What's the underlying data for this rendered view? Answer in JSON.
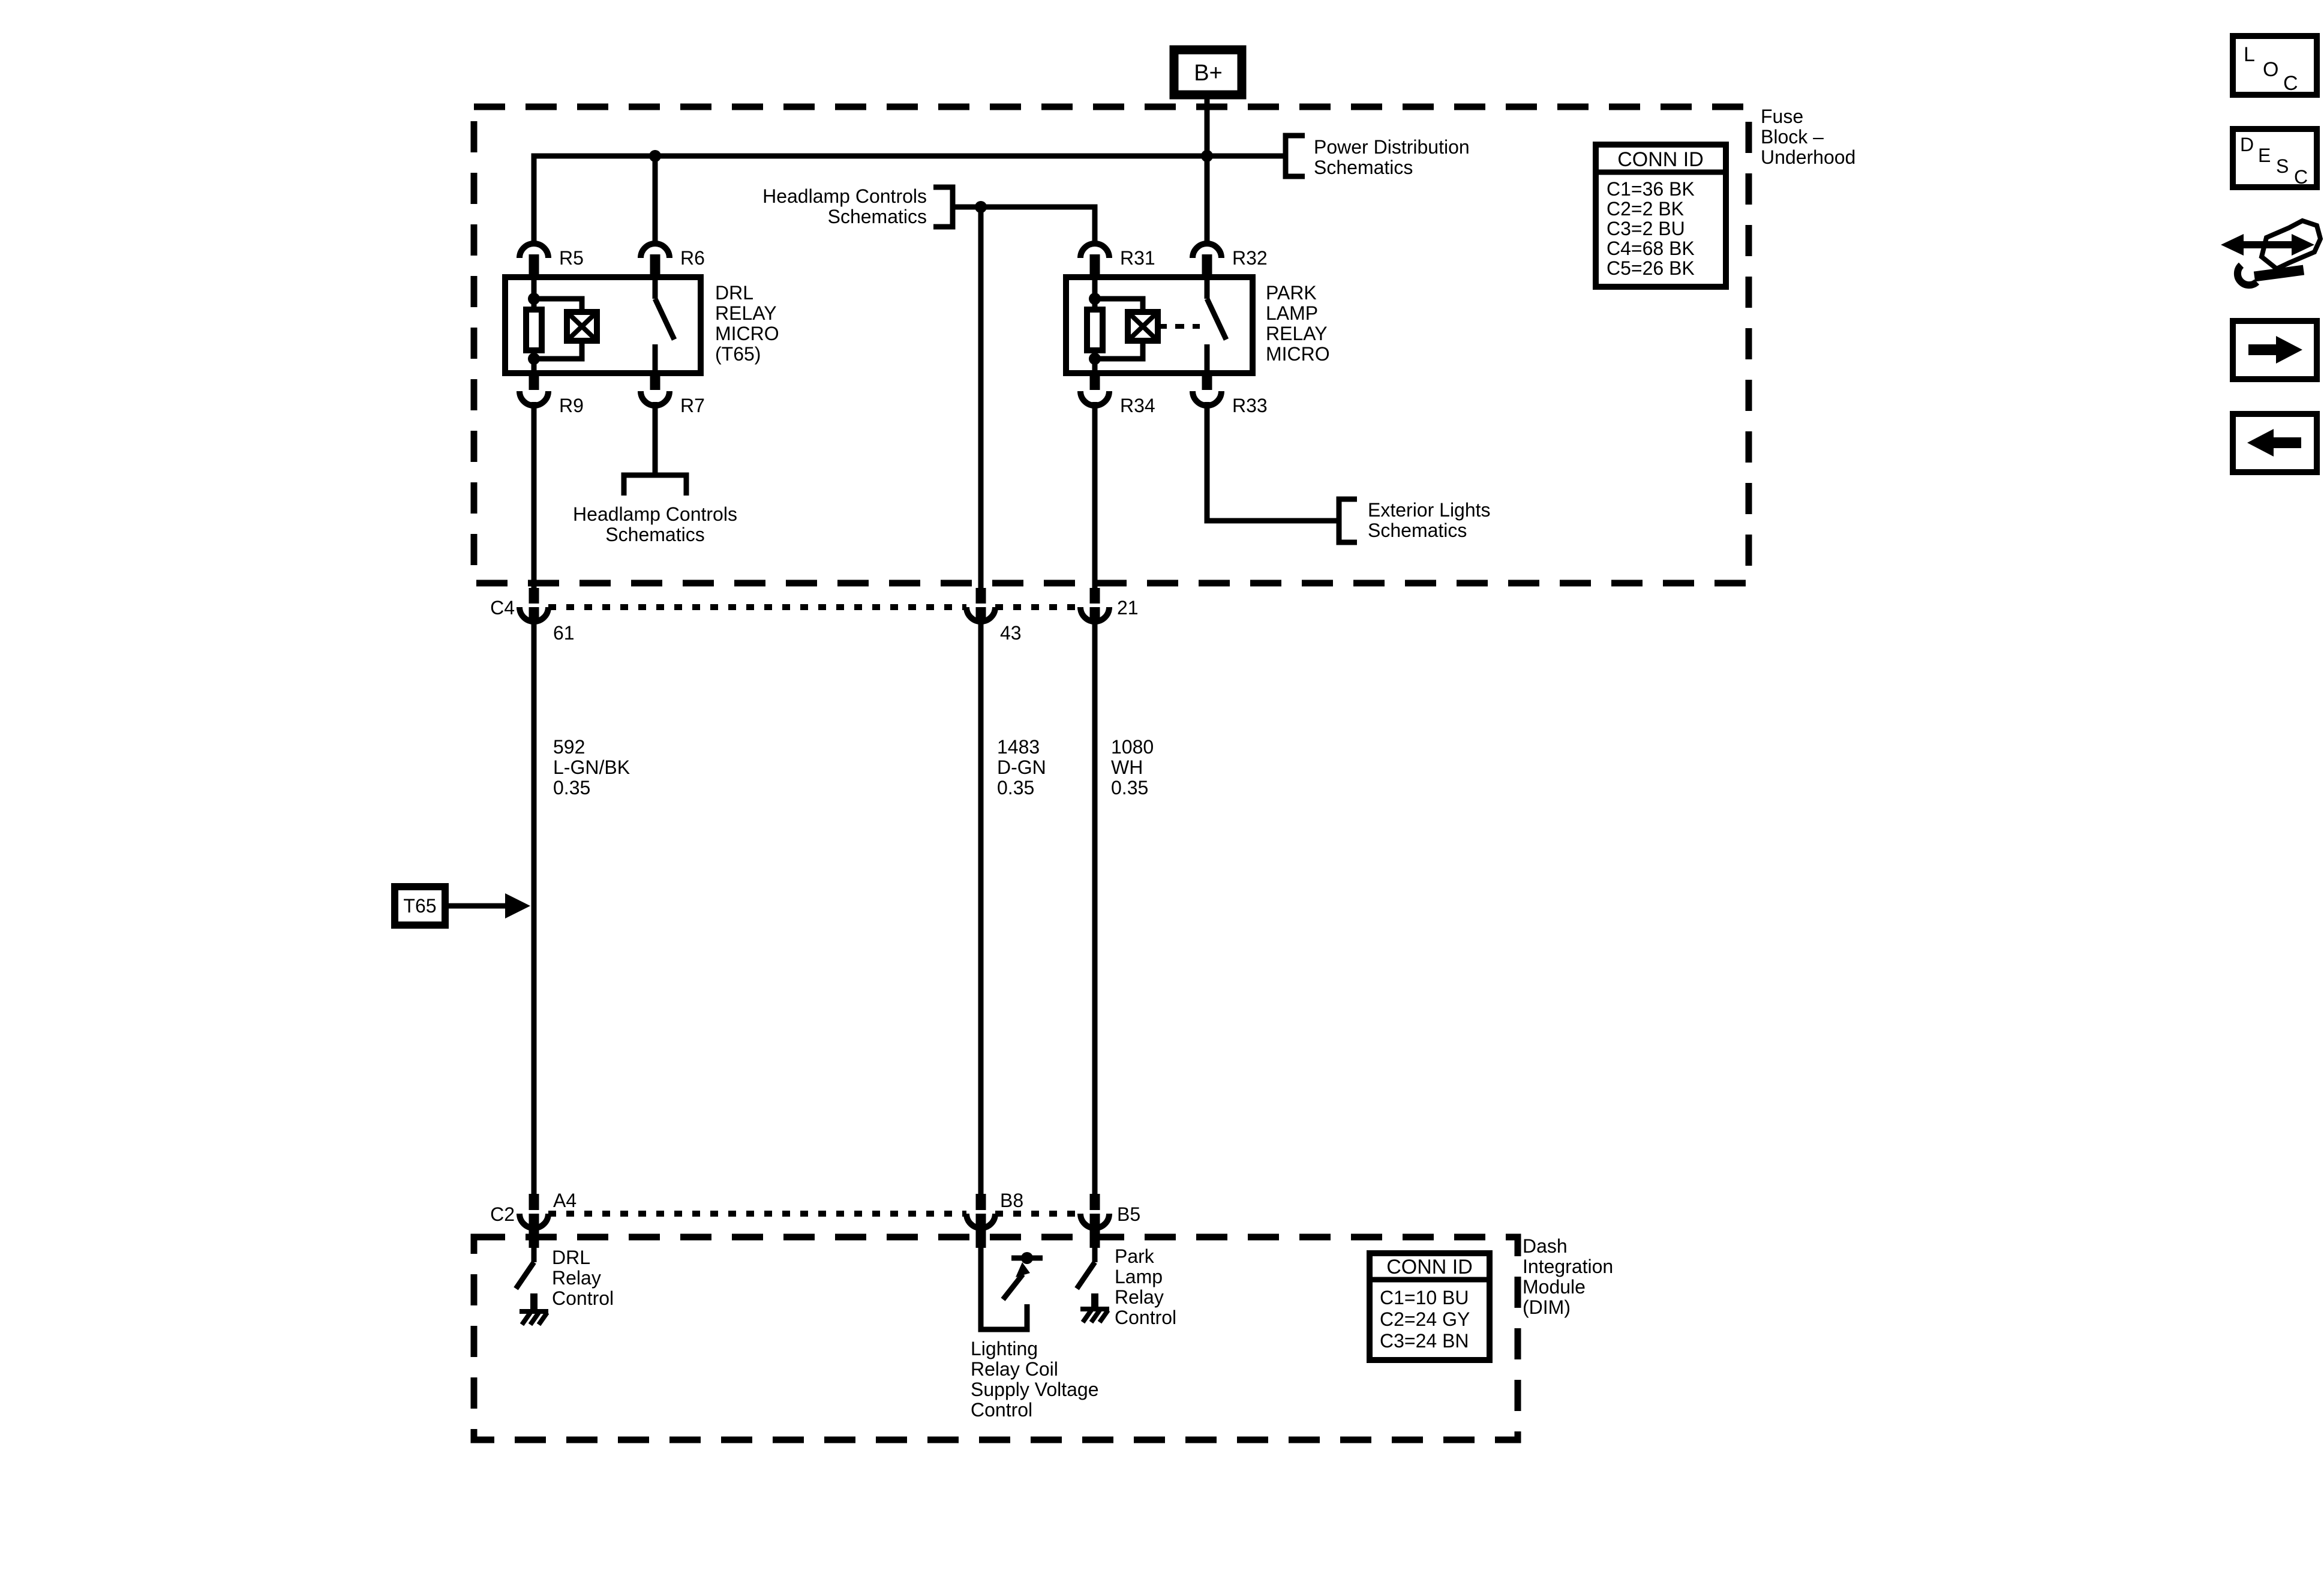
{
  "battery": {
    "label": "B+"
  },
  "toolbar": {
    "loc_letters": [
      "L",
      "O",
      "C"
    ],
    "desc_letters": [
      "D",
      "E",
      "S",
      "C"
    ]
  },
  "fuse_block": {
    "name_lines": [
      "Fuse",
      "Block –",
      "Underhood"
    ],
    "conn_id": {
      "title": "CONN ID",
      "rows": [
        "C1=36 BK",
        "C2=2 BK",
        "C3=2 BU",
        "C4=68 BK",
        "C5=26 BK"
      ]
    }
  },
  "refs": {
    "power_distribution": [
      "Power Distribution",
      "Schematics"
    ],
    "headlamp_top": [
      "Headlamp Controls",
      "Schematics"
    ],
    "headlamp_bottom": [
      "Headlamp Controls",
      "Schematics"
    ],
    "exterior_lights": [
      "Exterior Lights",
      "Schematics"
    ]
  },
  "relays": {
    "drl": {
      "name_lines": [
        "DRL",
        "RELAY",
        "MICRO",
        "(T65)"
      ],
      "pin_top_left": "R5",
      "pin_top_right": "R6",
      "pin_bottom_left": "R9",
      "pin_bottom_right": "R7"
    },
    "park": {
      "name_lines": [
        "PARK",
        "LAMP",
        "RELAY",
        "MICRO"
      ],
      "pin_top_left": "R31",
      "pin_top_right": "R32",
      "pin_bottom_left": "R34",
      "pin_bottom_right": "R33"
    }
  },
  "connector_rows": {
    "c4": {
      "label": "C4",
      "pins": [
        "61",
        "43",
        "21"
      ]
    },
    "c2": {
      "label": "C2",
      "pins": [
        "A4",
        "B8",
        "B5"
      ]
    }
  },
  "wires": [
    {
      "circuit": "592",
      "color": "L-GN/BK",
      "size": "0.35"
    },
    {
      "circuit": "1483",
      "color": "D-GN",
      "size": "0.35"
    },
    {
      "circuit": "1080",
      "color": "WH",
      "size": "0.35"
    }
  ],
  "callout": {
    "label": "T65"
  },
  "dim": {
    "name_lines": [
      "Dash",
      "Integration",
      "Module",
      "(DIM)"
    ],
    "conn_id": {
      "title": "CONN ID",
      "rows": [
        "C1=10 BU",
        "C2=24 GY",
        "C3=24 BN"
      ]
    },
    "functions": {
      "drl_relay_control": [
        "DRL",
        "Relay",
        "Control"
      ],
      "lighting_relay_coil_supply": [
        "Lighting",
        "Relay Coil",
        "Supply Voltage",
        "Control"
      ],
      "park_lamp_relay_control": [
        "Park",
        "Lamp",
        "Relay",
        "Control"
      ]
    }
  },
  "colors": {
    "ink": "#000000",
    "paper": "#ffffff"
  }
}
